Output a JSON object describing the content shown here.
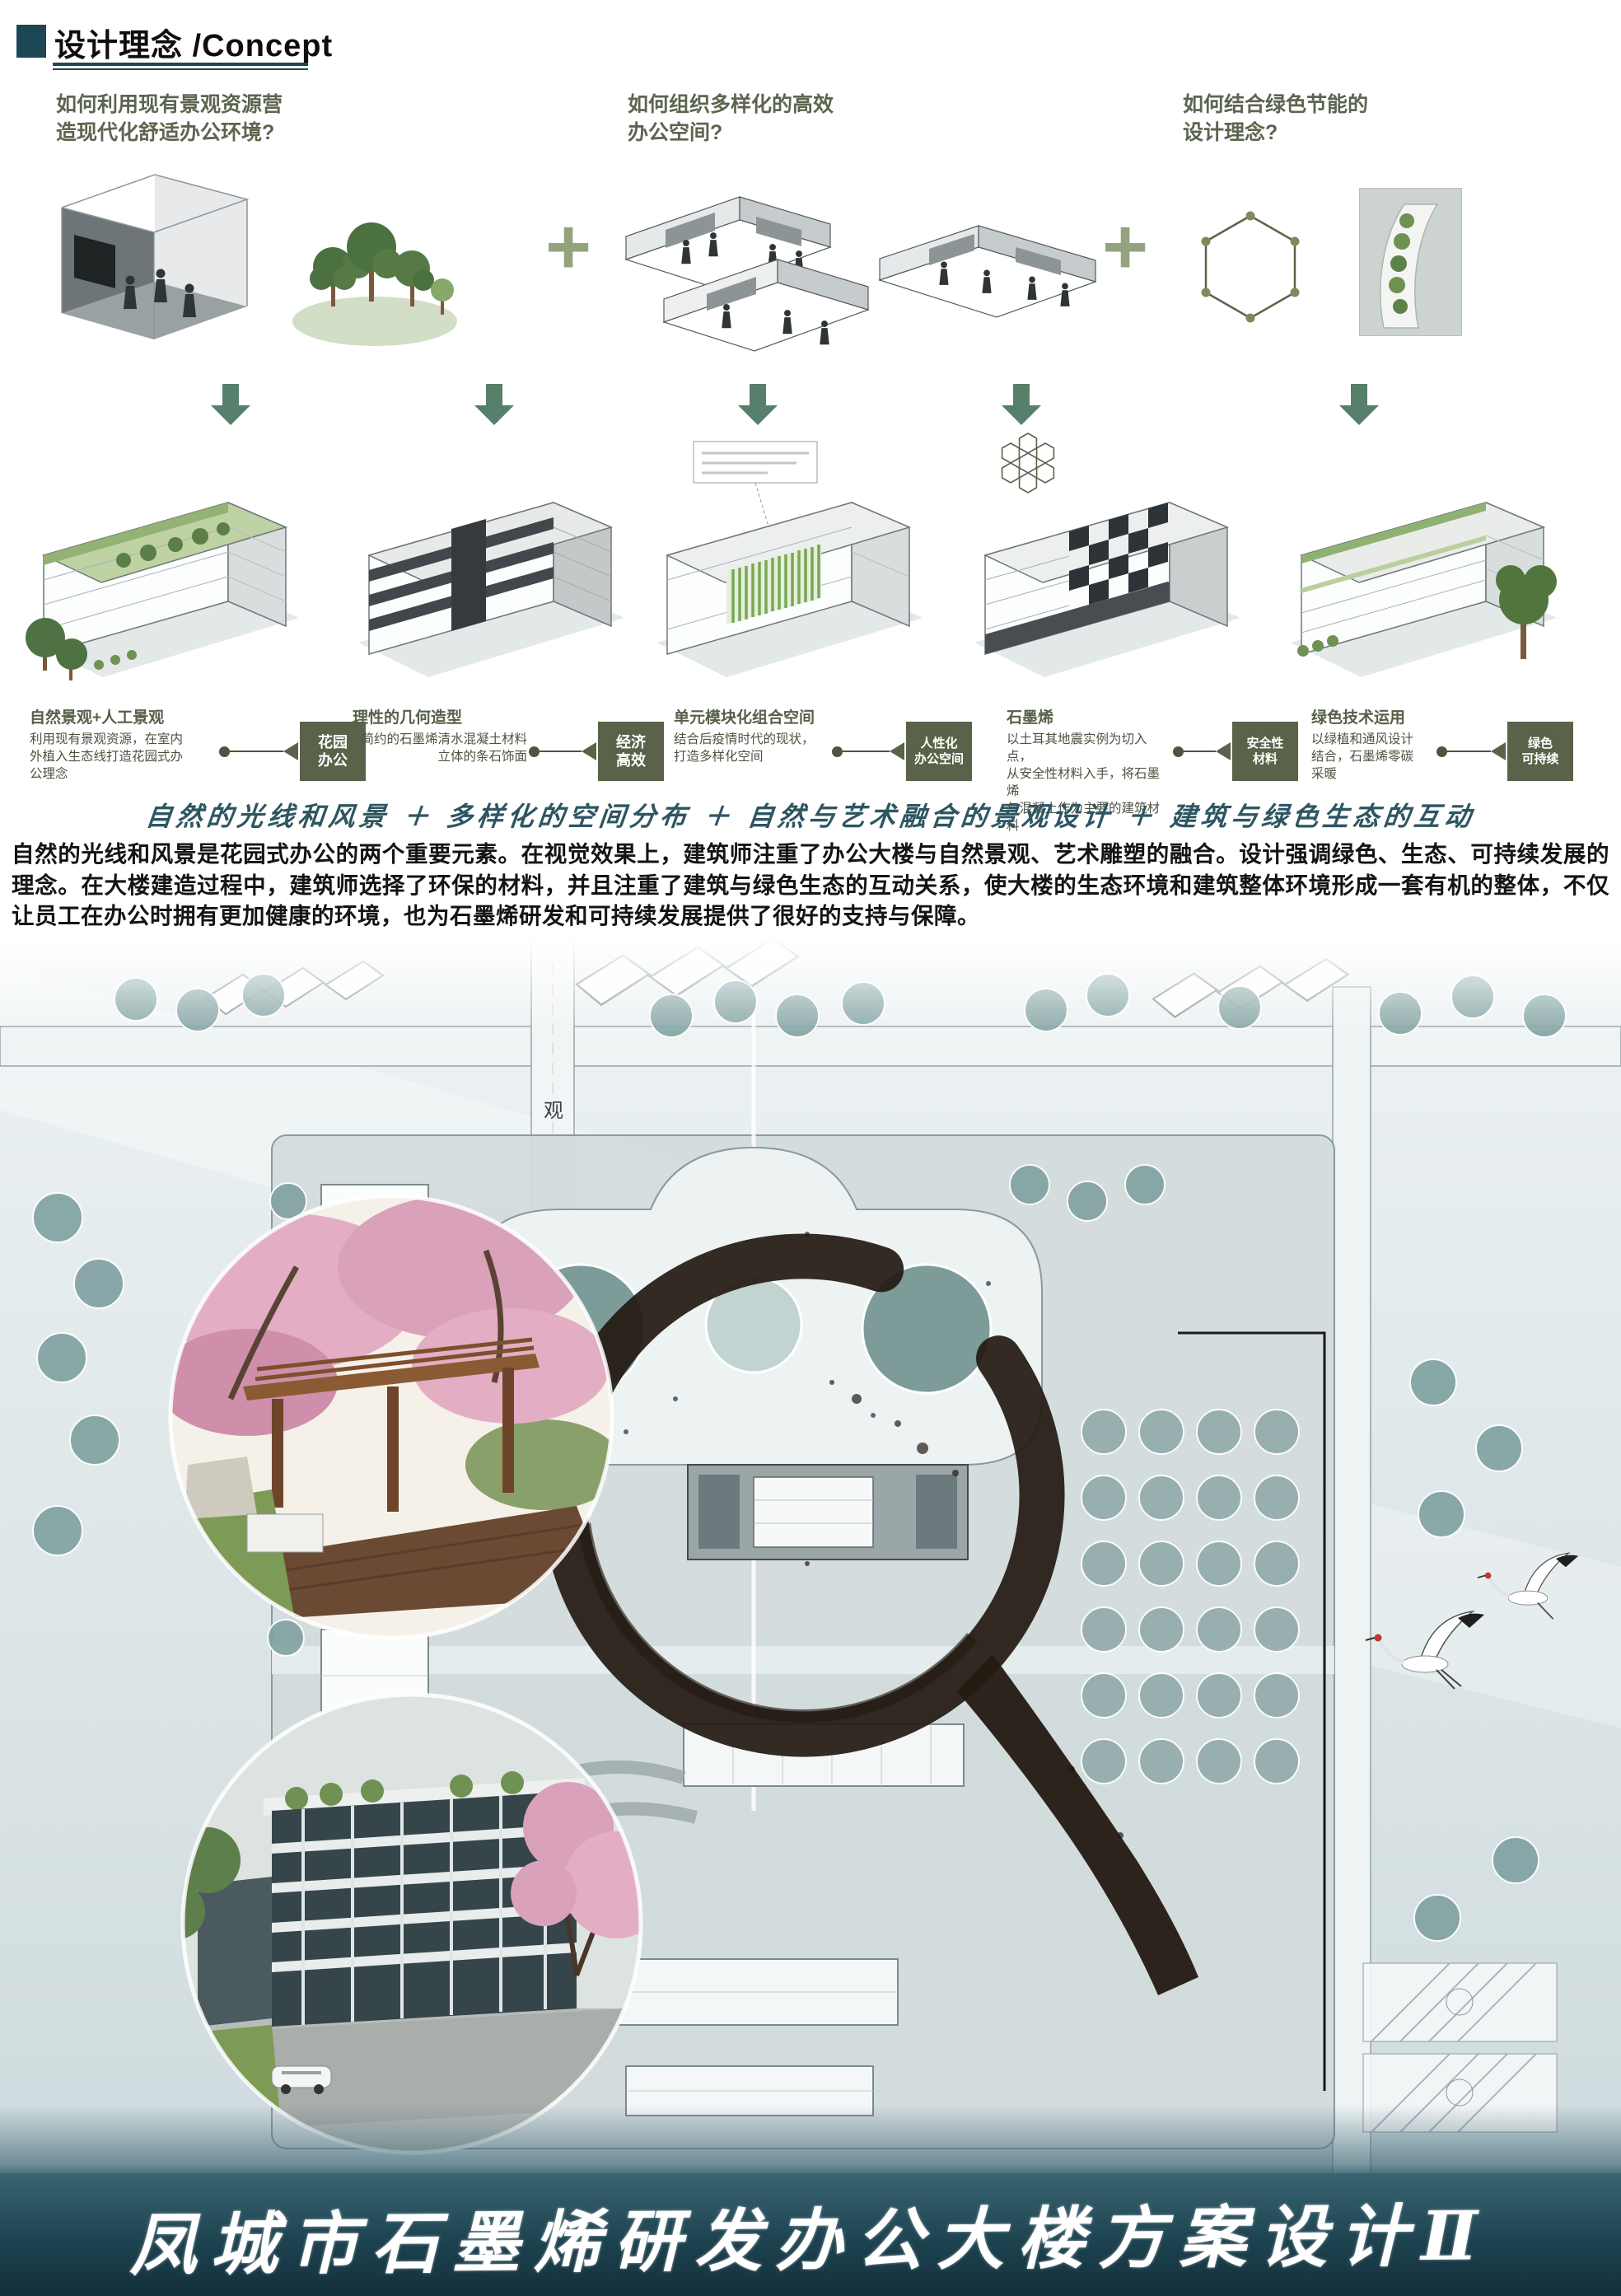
{
  "header": {
    "title": "设计理念 /Concept"
  },
  "questions": [
    "如何利用现有景观资源营\n造现代化舒适办公环境?",
    "如何组织多样化的高效\n办公空间?",
    "如何结合绿色节能的\n设计理念?"
  ],
  "icons": {
    "plus": "+"
  },
  "strategies": [
    {
      "title": "自然景观+人工景观",
      "desc": "利用现有景观资源，在室内\n外植入生态线打造花园式办\n公理念",
      "badge": "花园\n办公"
    },
    {
      "title": "理性的几何造型",
      "desc": "简约的石墨烯清水混凝土材料\n立体的条石饰面",
      "badge": "经济\n高效"
    },
    {
      "title": "单元模块化组合空间",
      "desc": "结合后疫情时代的现状，\n打造多样化空间",
      "badge": "人性化\n办公空间"
    },
    {
      "title": "石墨烯",
      "desc": "以土耳其地震实例为切入点，\n从安全性材料入手，将石墨烯\n与混凝土作为主要的建筑材料",
      "badge": "安全性\n材料"
    },
    {
      "title": "绿色技术运用",
      "desc": "以绿植和通风设计\n结合，石墨烯零碳\n采暖",
      "badge": "绿色\n可持续"
    }
  ],
  "slogan": "自然的光线和风景 ＋ 多样化的空间分布 ＋ 自然与艺术融合的景观设计 ＋ 建筑与绿色生态的互动",
  "paragraph": "自然的光线和风景是花园式办公的两个重要元素。在视觉效果上，建筑师注重了办公大楼与自然景观、艺术雕塑的融合。设计强调绿色、生态、可持续发展的理念。在大楼建造过程中，建筑师选择了环保的材料，并且注重了建筑与绿色生态的互动关系，使大楼的生态环境和建筑整体环境形成一套有机的整体，不仅让员工在办公时拥有更加健康的环境，也为石墨烯研发和可持续发展提供了很好的支持与保障。",
  "site_plan": {
    "road_label": "观"
  },
  "footer": {
    "title": "凤城市石墨烯研发办公大楼方案设计Ⅱ"
  },
  "colors": {
    "accent_teal": "#1d4654",
    "olive": "#5a6349",
    "question_green": "#5d6550",
    "arrow_green": "#56806b",
    "ink": "#241a12"
  }
}
